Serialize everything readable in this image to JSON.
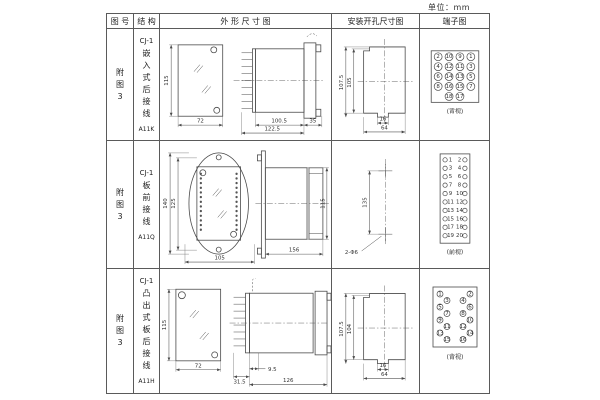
{
  "unit_label": "单位：mm",
  "columns": {
    "fig": "图 号",
    "structure": "结 构",
    "outline": "外 形 尺 寸 图",
    "mounting": "安装开孔尺寸图",
    "terminal": "端子图"
  },
  "rows": [
    {
      "fig": "附图3",
      "model": "CJ-1",
      "structure": "嵌入式后接线",
      "code": "A11K",
      "outline": {
        "front_h": "115",
        "front_w": "72",
        "len1": "100.5",
        "len2": "122.5",
        "len3": "35"
      },
      "mounting": {
        "v1": "107.5",
        "v2": "105",
        "h1": "16",
        "h2": "64"
      },
      "terminal": {
        "view": "(背视)",
        "pin_r": 4,
        "fs": 4.2,
        "pins": [
          {
            "x": 18,
            "y": 28,
            "n": "2"
          },
          {
            "x": 29,
            "y": 28,
            "n": "10"
          },
          {
            "x": 40,
            "y": 28,
            "n": "9"
          },
          {
            "x": 51,
            "y": 28,
            "n": "1"
          },
          {
            "x": 18,
            "y": 38,
            "n": "4"
          },
          {
            "x": 29,
            "y": 38,
            "n": "12"
          },
          {
            "x": 40,
            "y": 38,
            "n": "11"
          },
          {
            "x": 51,
            "y": 38,
            "n": "3"
          },
          {
            "x": 18,
            "y": 48,
            "n": "6"
          },
          {
            "x": 29,
            "y": 48,
            "n": "14"
          },
          {
            "x": 40,
            "y": 48,
            "n": "13"
          },
          {
            "x": 51,
            "y": 48,
            "n": "5"
          },
          {
            "x": 18,
            "y": 58,
            "n": "8"
          },
          {
            "x": 29,
            "y": 58,
            "n": "16"
          },
          {
            "x": 40,
            "y": 58,
            "n": "15"
          },
          {
            "x": 51,
            "y": 58,
            "n": "7"
          },
          {
            "x": 29,
            "y": 68,
            "n": "18"
          },
          {
            "x": 40,
            "y": 68,
            "n": "17"
          }
        ]
      }
    },
    {
      "fig": "附图3",
      "model": "CJ-1",
      "structure": "板前接线",
      "code": "A11Q",
      "outline": {
        "front_h1": "140",
        "front_h2": "125",
        "front_w": "105",
        "side_len": "156",
        "side_h": "115"
      },
      "mounting": {
        "v1": "135",
        "holes": "2-Φ6"
      },
      "terminal": {
        "view": "(前视)",
        "pin_r": 2.2,
        "fs": 4,
        "pins": [
          {
            "x": 25,
            "y": 19,
            "n": "1",
            "lx": 30.5
          },
          {
            "x": 45,
            "y": 19,
            "n": "2",
            "lx": 39.5
          },
          {
            "x": 25,
            "y": 27.5,
            "n": "3",
            "lx": 30.5
          },
          {
            "x": 45,
            "y": 27.5,
            "n": "4",
            "lx": 39.5
          },
          {
            "x": 25,
            "y": 36,
            "n": "5",
            "lx": 30.5
          },
          {
            "x": 45,
            "y": 36,
            "n": "6",
            "lx": 39.5
          },
          {
            "x": 25,
            "y": 44.5,
            "n": "7",
            "lx": 30.5
          },
          {
            "x": 45,
            "y": 44.5,
            "n": "8",
            "lx": 39.5
          },
          {
            "x": 25,
            "y": 53,
            "n": "9",
            "lx": 30.5
          },
          {
            "x": 45,
            "y": 53,
            "n": "10",
            "lx": 39.5
          },
          {
            "x": 25,
            "y": 61.5,
            "n": "11",
            "lx": 30.5
          },
          {
            "x": 45,
            "y": 61.5,
            "n": "12",
            "lx": 39.5
          },
          {
            "x": 25,
            "y": 70,
            "n": "13",
            "lx": 30.5
          },
          {
            "x": 45,
            "y": 70,
            "n": "14",
            "lx": 39.5
          },
          {
            "x": 25,
            "y": 78.5,
            "n": "15",
            "lx": 30.5
          },
          {
            "x": 45,
            "y": 78.5,
            "n": "16",
            "lx": 39.5
          },
          {
            "x": 25,
            "y": 87,
            "n": "17",
            "lx": 30.5
          },
          {
            "x": 45,
            "y": 87,
            "n": "18",
            "lx": 39.5
          },
          {
            "x": 25,
            "y": 95.5,
            "n": "19",
            "lx": 30.5
          },
          {
            "x": 45,
            "y": 95.5,
            "n": "20",
            "lx": 39.5
          }
        ]
      }
    },
    {
      "fig": "附图3",
      "model": "CJ-1",
      "structure": "凸出式板后接线",
      "code": "A11H",
      "outline": {
        "front_h": "115",
        "front_w": "72",
        "len1": "31.5",
        "len2": "9.5",
        "len3": "126"
      },
      "mounting": {
        "v1": "107.5",
        "v2": "104",
        "h1": "16",
        "h2": "64"
      },
      "terminal": {
        "view": "(背视)",
        "pin_r": 3,
        "fs": 3.6,
        "pins": [
          {
            "x": 20,
            "y": 25,
            "n": "1"
          },
          {
            "x": 50,
            "y": 25,
            "n": "2"
          },
          {
            "x": 27,
            "y": 31.5,
            "n": "3"
          },
          {
            "x": 43,
            "y": 31.5,
            "n": "4"
          },
          {
            "x": 20,
            "y": 38,
            "n": "5"
          },
          {
            "x": 50,
            "y": 38,
            "n": "6"
          },
          {
            "x": 27,
            "y": 44.5,
            "n": "7"
          },
          {
            "x": 43,
            "y": 44.5,
            "n": "8"
          },
          {
            "x": 20,
            "y": 51,
            "n": "9"
          },
          {
            "x": 50,
            "y": 51,
            "n": "10"
          },
          {
            "x": 27,
            "y": 57.5,
            "n": "11"
          },
          {
            "x": 43,
            "y": 57.5,
            "n": "12"
          },
          {
            "x": 20,
            "y": 64,
            "n": "13"
          },
          {
            "x": 50,
            "y": 64,
            "n": "14"
          },
          {
            "x": 27,
            "y": 70.5,
            "n": "15"
          },
          {
            "x": 43,
            "y": 70.5,
            "n": "16"
          }
        ]
      }
    }
  ]
}
